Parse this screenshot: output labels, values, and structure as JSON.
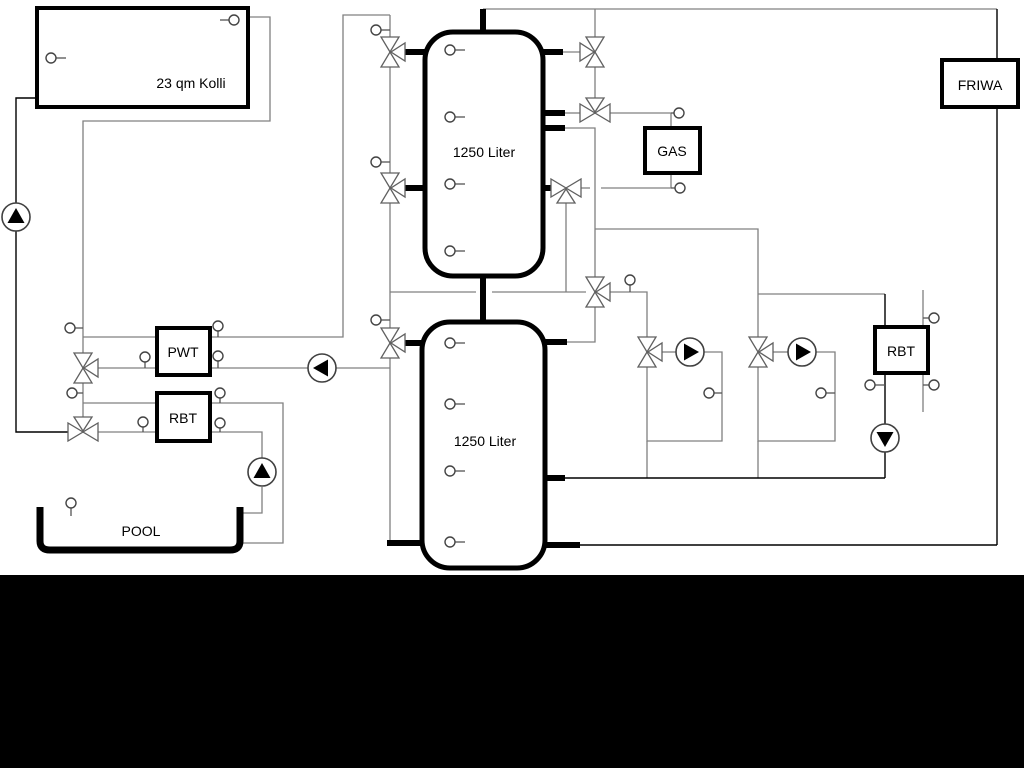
{
  "diagram_title": "heating-solar-pool-schematic",
  "labels": {
    "collector": "23 qm Kolli",
    "upper_tank": "1250 Liter",
    "lower_tank": "1250 Liter",
    "gas": "GAS",
    "friwa": "FRIWA",
    "pwt": "PWT",
    "rbt_left": "RBT",
    "rbt_right": "RBT",
    "pool": "POOL"
  },
  "colors": {
    "pipe_gray": "#808080",
    "pipe_black": "#000000",
    "component_outline": "#000000",
    "valve_outline": "#606060",
    "background": "#ffffff",
    "bottom_band": "#000000"
  },
  "component_counts": {
    "pumps": 6,
    "three_way_valves": 11,
    "temperature_sensors": 25,
    "buffer_tanks": 2
  }
}
